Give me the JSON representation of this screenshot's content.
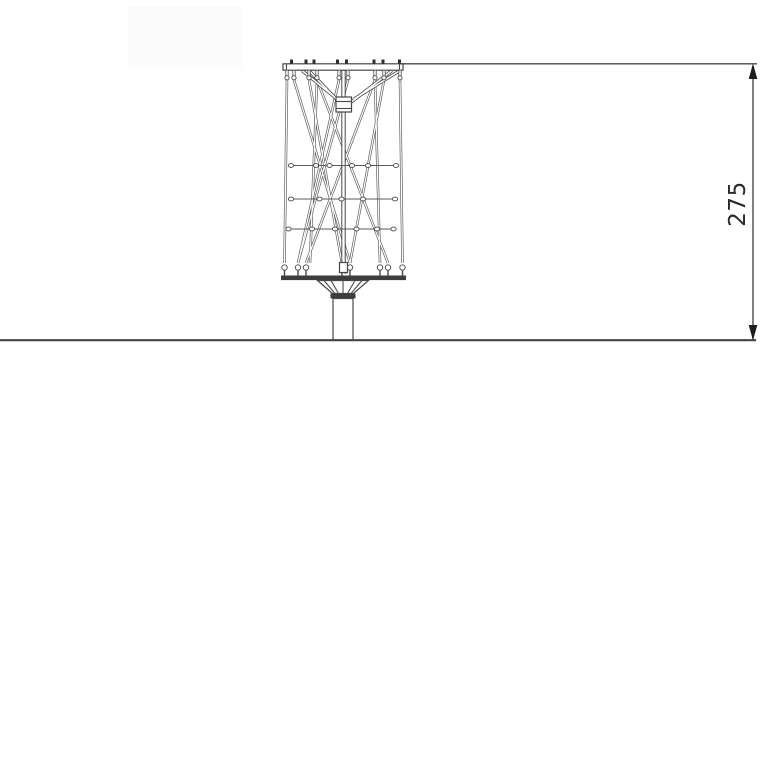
{
  "drawing": {
    "dimension": {
      "label": "275"
    },
    "colors": {
      "line": "#4a4a4a",
      "dark_fill": "#3d3d3d",
      "arrow": "#1d1d1d",
      "text": "#2b2b2b",
      "background": "#ffffff"
    },
    "icons": {
      "arrow_up": "filled-triangle-up",
      "arrow_down": "filled-triangle-down"
    }
  }
}
